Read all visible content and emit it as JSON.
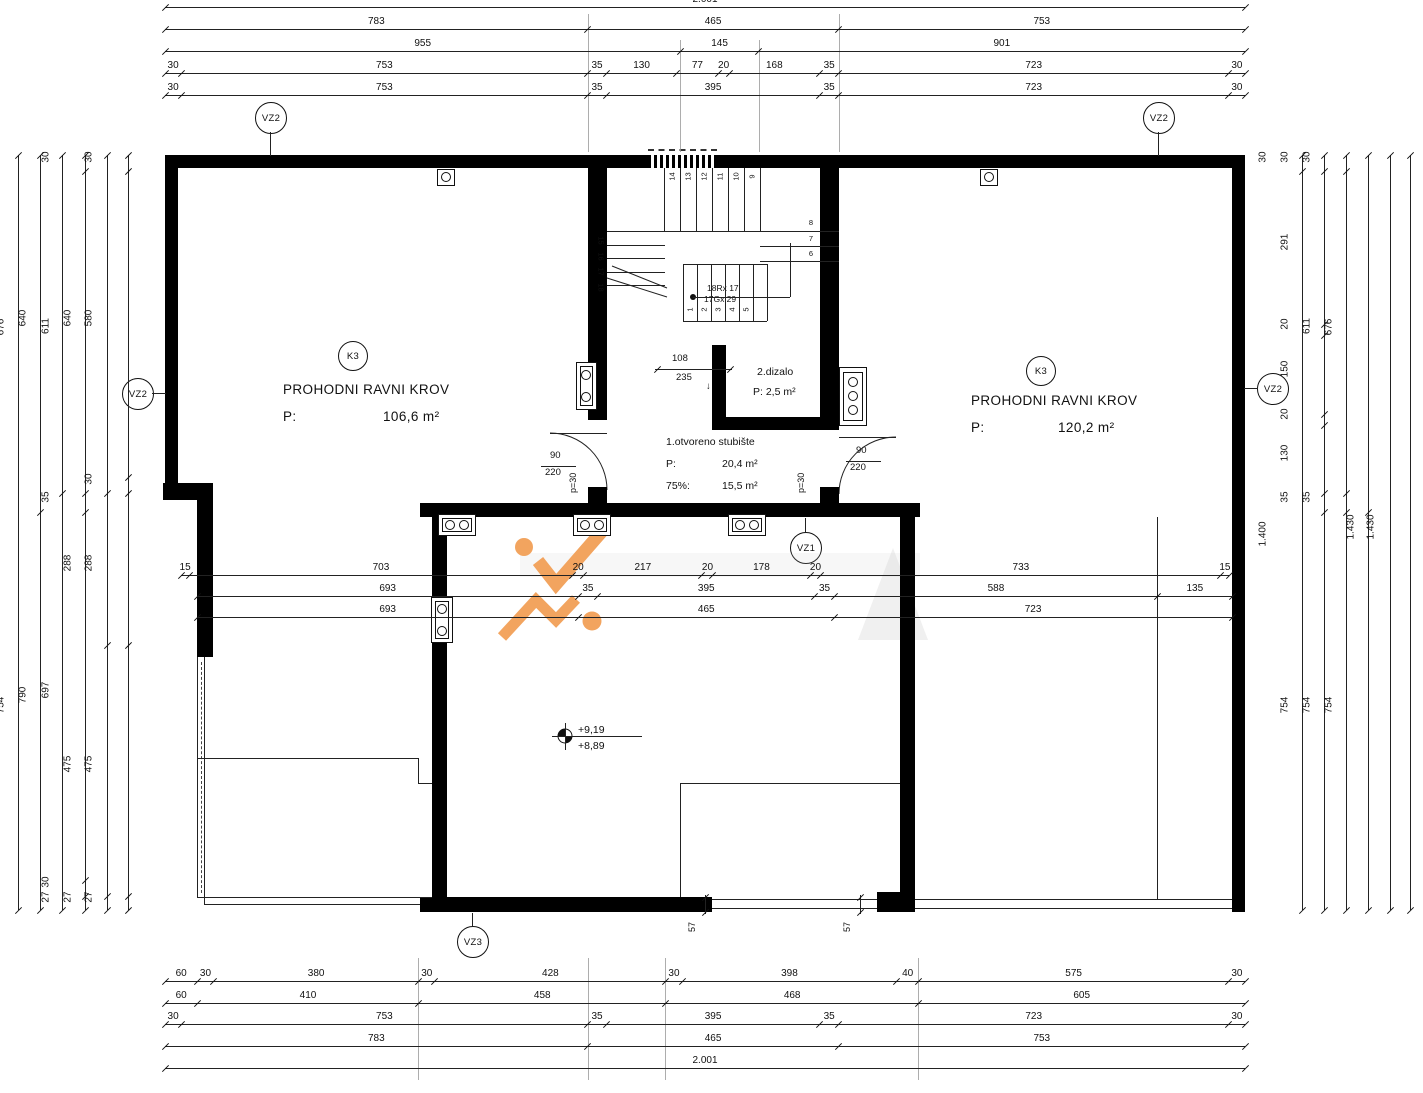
{
  "drawing_title": "roof-plan",
  "rooms": [
    {
      "tag": "K3",
      "title": "PROHODNI RAVNI KROV",
      "area_label": "P:",
      "area": "106,6 m²"
    },
    {
      "tag": "K3",
      "title": "PROHODNI RAVNI KROV",
      "area_label": "P:",
      "area": "120,2 m²"
    }
  ],
  "stairwell": {
    "label": "1.otvoreno stubište",
    "area_label": "P:",
    "area": "20,4 m²",
    "pct_label": "75%:",
    "pct_area": "15,5 m²",
    "riser_spec": "18Rx 17",
    "going_spec": "17Gx 29",
    "dim_width": "108",
    "dim_total": "235",
    "arrow": "↓",
    "slope": "p=30"
  },
  "elevator": {
    "label": "2.dizalo",
    "area": "P: 2,5 m²"
  },
  "doors": {
    "left": {
      "width": "90",
      "height": "220",
      "sill": "p=30"
    },
    "right": {
      "width": "90",
      "height": "220",
      "sill": "p=30"
    }
  },
  "levels": {
    "upper": "+9,19",
    "lower": "+8,89"
  },
  "markers": [
    "VZ2",
    "VZ2",
    "VZ2",
    "VZ2",
    "VZ1",
    "VZ3"
  ],
  "edge_dims": [
    "57",
    "57"
  ],
  "stair_numbers": {
    "top": [
      "14",
      "13",
      "12",
      "11",
      "10",
      "9"
    ],
    "right": [
      "8",
      "7",
      "6"
    ],
    "bottom": [
      "1",
      "2",
      "3",
      "4",
      "5"
    ],
    "left": [
      "15",
      "16",
      "17",
      "18"
    ]
  },
  "dim_chains": {
    "top": [
      [
        "2.001"
      ],
      [
        "783",
        "465",
        "753"
      ],
      [
        "955",
        "145",
        "901"
      ],
      [
        "30",
        "753",
        "35",
        "130",
        "77",
        "20",
        "168",
        "35",
        "723",
        "30"
      ],
      [
        "30",
        "753",
        "35",
        "395",
        "35",
        "723",
        "30"
      ]
    ],
    "bottom": [
      [
        "60",
        "30",
        "380",
        "30",
        "428",
        "30",
        "398",
        "40",
        "575",
        "30"
      ],
      [
        "60",
        "410",
        "458",
        "468",
        "605"
      ],
      [
        "30",
        "753",
        "35",
        "395",
        "35",
        "723",
        "30"
      ],
      [
        "783",
        "465",
        "753"
      ],
      [
        "2.001"
      ]
    ],
    "left": [
      [
        "1.430"
      ],
      [
        "676",
        "754"
      ],
      [
        "640",
        "790"
      ],
      [
        "30",
        "611",
        "35",
        "697",
        "30",
        "27"
      ],
      [
        "640",
        "288",
        "475",
        "27"
      ],
      [
        "30",
        "580",
        "30",
        "288",
        "475",
        "27"
      ]
    ],
    "right": [
      [
        "30",
        "1.400"
      ],
      [
        "30",
        "291",
        "20",
        "150",
        "20",
        "130",
        "35",
        "754"
      ],
      [
        "30",
        "611",
        "35",
        "754"
      ],
      [
        "676",
        "754"
      ],
      [
        "1.430"
      ],
      [
        "1.430"
      ]
    ],
    "middle": [
      [
        "15",
        "703",
        "20",
        "217",
        "20",
        "178",
        "20",
        "733",
        "15"
      ],
      [
        "693",
        "35",
        "395",
        "35",
        "588",
        "135"
      ],
      [
        "693",
        "465",
        "723"
      ]
    ]
  },
  "watermark": {
    "accent": "#F2A057",
    "shadow": "#c9c9c9"
  }
}
